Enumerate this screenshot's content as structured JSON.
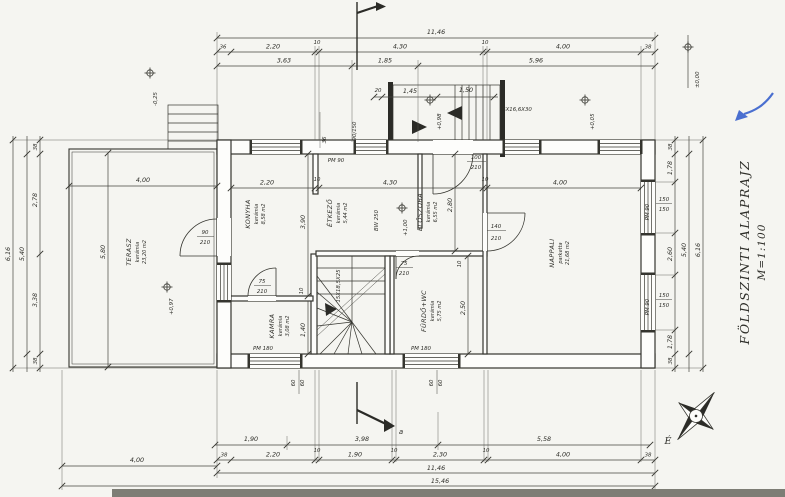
{
  "title": {
    "line1": "FÖLDSZINTI ALAPRAJZ",
    "line2": "M=1:100"
  },
  "north": {
    "label": "É"
  },
  "section": {
    "label": "a"
  },
  "colors": {
    "ink": "#35352f",
    "blue_pen": "#4a6fd0",
    "paper": "#f5f5f1"
  },
  "rooms": {
    "terasz": {
      "name": "TERASZ",
      "finish": "kerámia",
      "area": "23,20 m2"
    },
    "konyha": {
      "name": "KONYHA",
      "finish": "kerámia",
      "area": "8,58 m2"
    },
    "etkezo": {
      "name": "ÉTKEZŐ",
      "finish": "kerámia",
      "area": "5,44 m2"
    },
    "eloszoba": {
      "name": "ELŐSZOBA",
      "finish": "kerámia",
      "area": "6,55 m2"
    },
    "kamra": {
      "name": "KAMRA",
      "finish": "kerámia",
      "area": "3,08 m2"
    },
    "furdo": {
      "name": "FÜRDŐ+WC",
      "finish": "kerámia",
      "area": "5,75 m2"
    },
    "nappali": {
      "name": "NAPPALI",
      "finish": "parketta",
      "area": "21,68 m2"
    }
  },
  "dims": {
    "top_total": "11,46",
    "top_chain": [
      "36",
      "2,20",
      "10",
      "4,30",
      "10",
      "4,00",
      "38"
    ],
    "top_sub": [
      "3,63",
      "1,85",
      "5,96"
    ],
    "porch_chain": [
      "20",
      "1,45",
      "1,50"
    ],
    "interior_chain": [
      "2,20",
      "10",
      "4,30",
      "10",
      "4,00"
    ],
    "bottom_axes": [
      "1,90",
      "3,98",
      "5,58"
    ],
    "bottom_chain": [
      "38",
      "2,20",
      "10",
      "1,90",
      "10",
      "2,30",
      "10",
      "4,00",
      "38"
    ],
    "bottom_total": "11,46",
    "bottom_overall": "15,46",
    "terrace_width": "4,00",
    "terrace_inner_width": "4,00",
    "terrace_depth": "5,80",
    "left_chain": [
      "38",
      "2,78",
      "3,38",
      "38"
    ],
    "left_inner": "5,40",
    "left_total": "6,16",
    "right_chain": [
      "38",
      "1,78",
      "2,60",
      "1,78",
      "38"
    ],
    "right_inner": "5,40",
    "right_total": "6,16",
    "konyha_depth": "3,90",
    "kamra_depth": "1,40",
    "hall_depth": "2,80",
    "bath_depth": "2,50",
    "partition": "10",
    "wall_36": "36",
    "sill": "60"
  },
  "windows": {
    "pm90": "PM 90",
    "pm180": "PM 180",
    "size_90_150": "90/150",
    "size_150": "150"
  },
  "doors": {
    "d90": "90",
    "d75": "75",
    "d100": "100",
    "d140": "140",
    "h210": "210"
  },
  "elevations": {
    "zero": "±0,00",
    "minus_025": "-0,25",
    "plus_005": "+0,05",
    "plus_098": "+0,98",
    "plus_100": "+1,00",
    "plus_097": "+0,97"
  },
  "stairs": {
    "internal": "15X18,5X25",
    "external": "6X16,6X30"
  }
}
